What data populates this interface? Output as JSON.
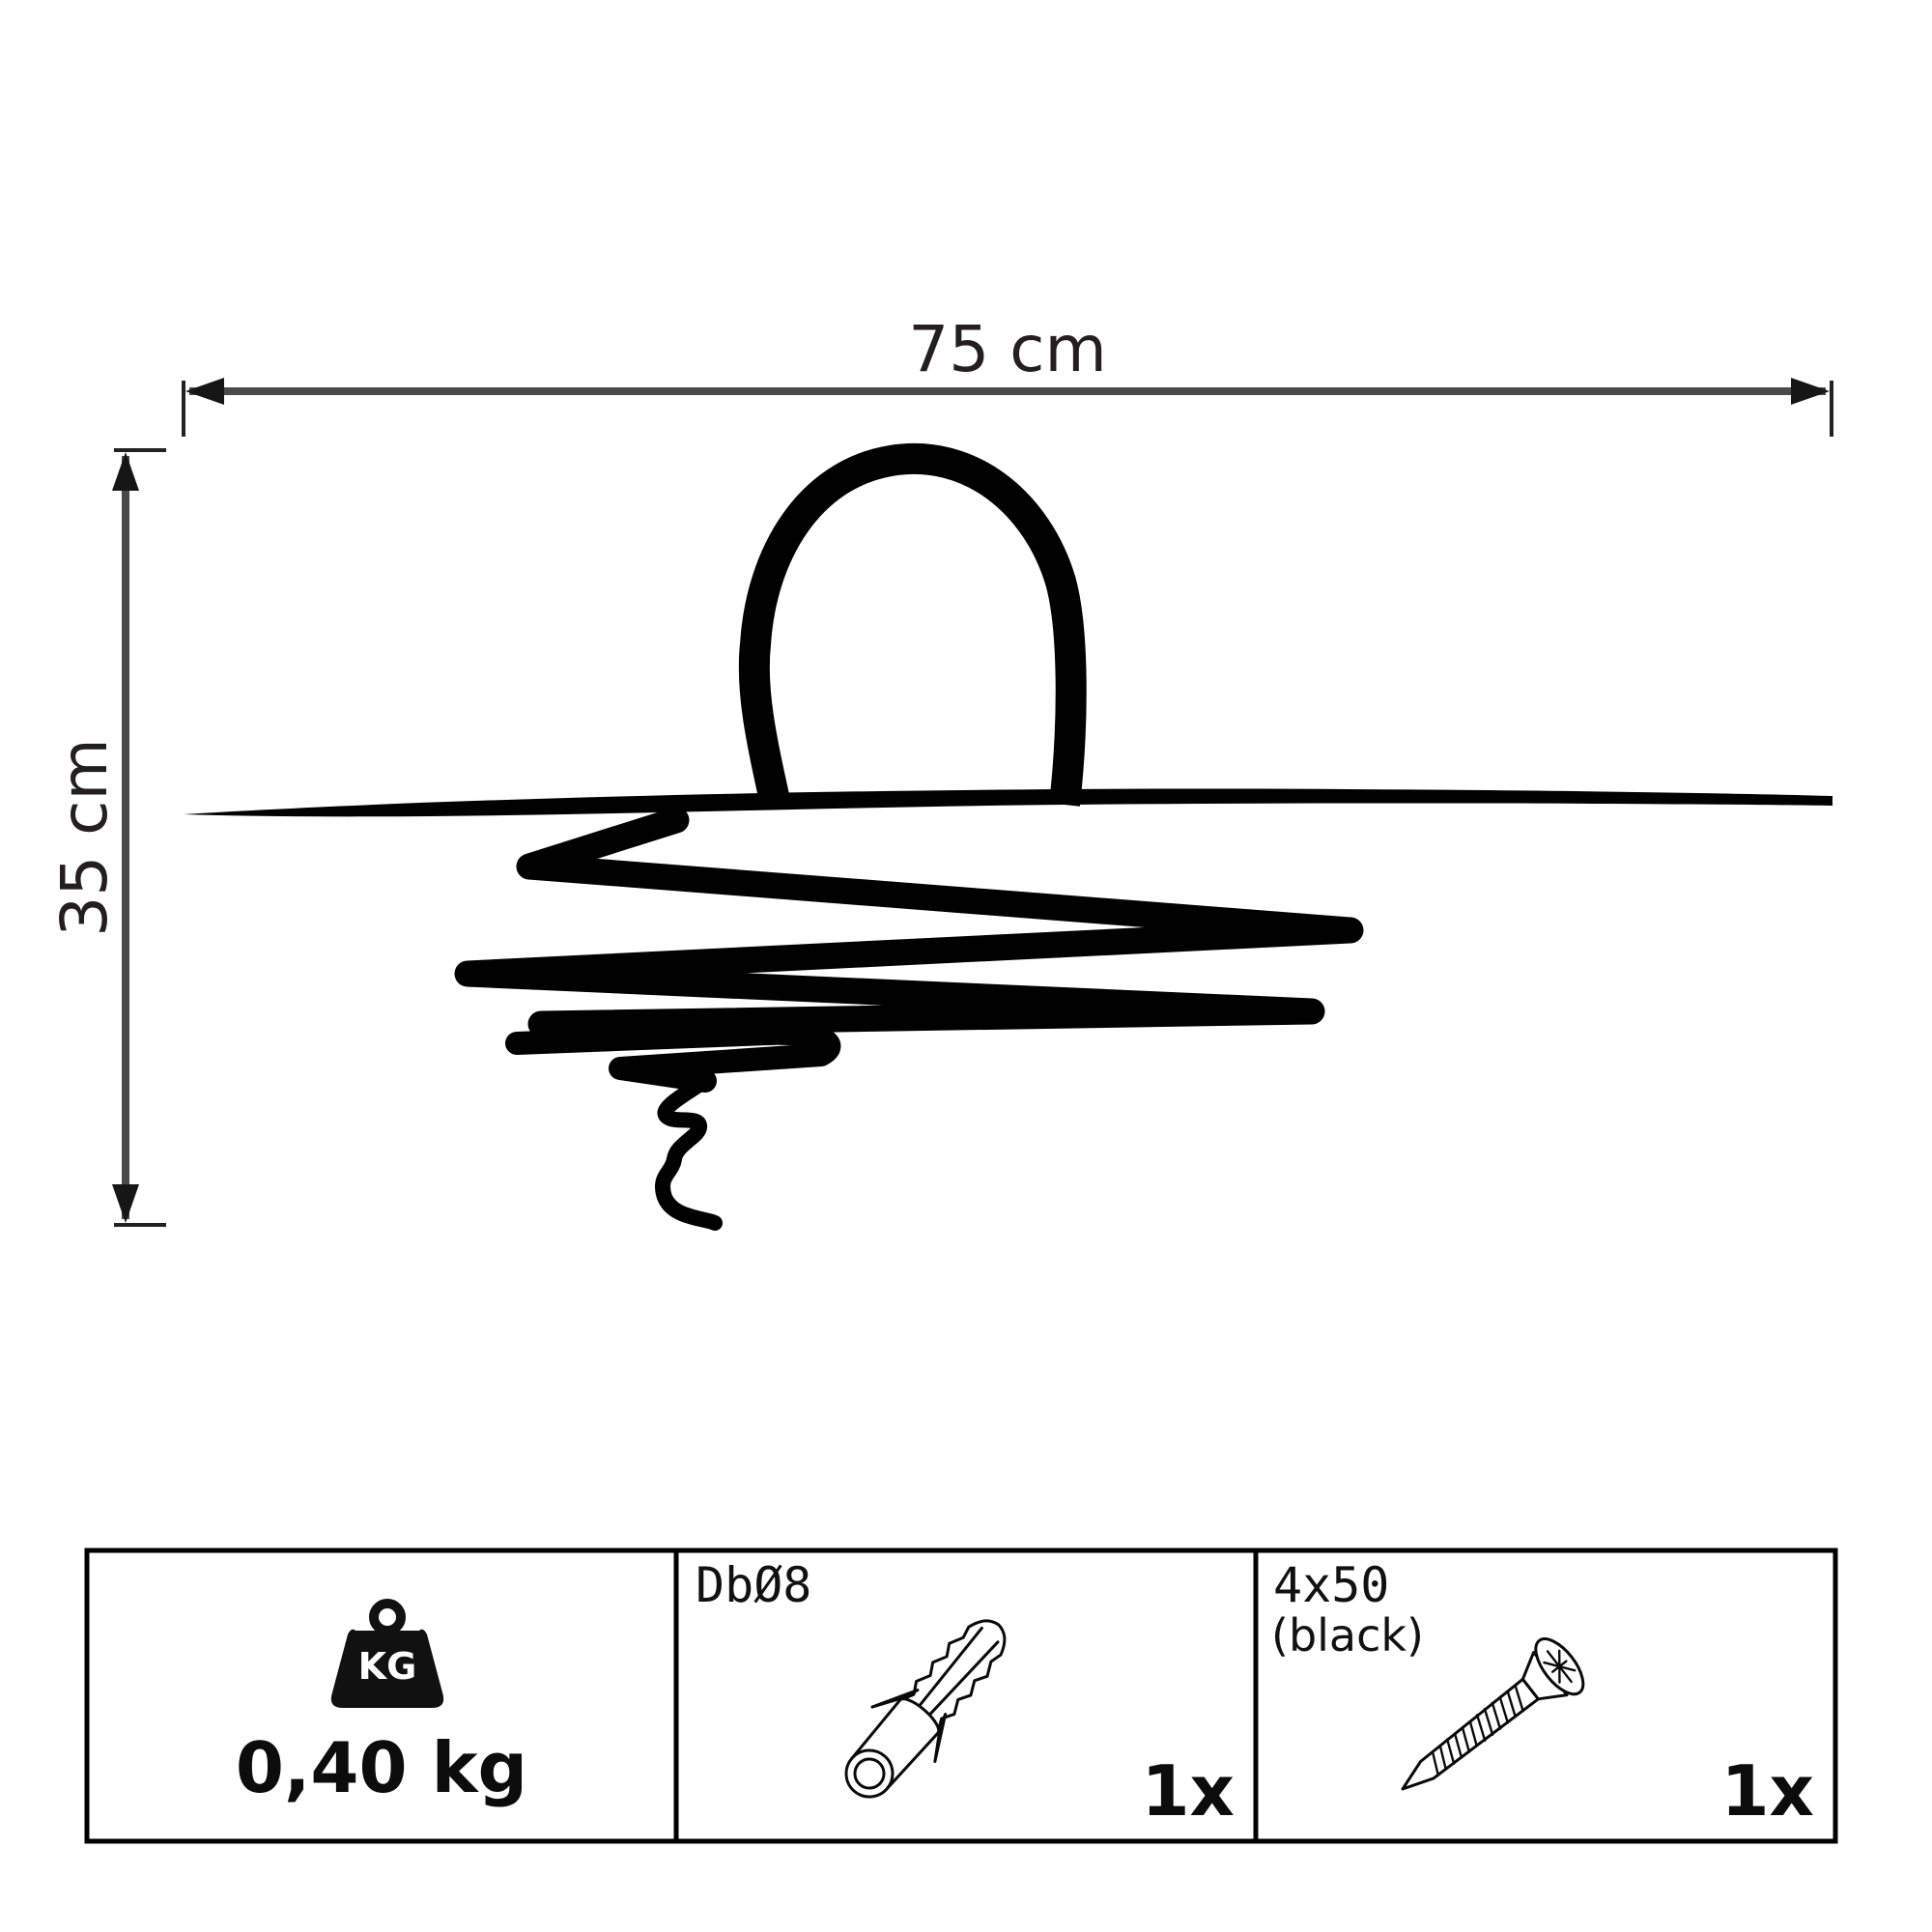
{
  "dimension_labels": {
    "width": "75 cm",
    "height": "35 cm"
  },
  "specs_table": {
    "weight_cell": {
      "icon": "kg-weight-icon",
      "icon_text": "KG",
      "value": "0,40 kg"
    },
    "dowel_cell": {
      "icon": "wall-plug-icon",
      "label": "DbØ8",
      "quantity": "1x"
    },
    "screw_cell": {
      "icon": "screw-icon",
      "label": "4x50",
      "sublabel": "(black)",
      "quantity": "1x"
    }
  },
  "colors": {
    "ink": "#010101",
    "dim_line": "#4a4a4a",
    "tick": "#222222",
    "arrow": "#161616",
    "text": "#231f20",
    "table_border": "#000000"
  }
}
